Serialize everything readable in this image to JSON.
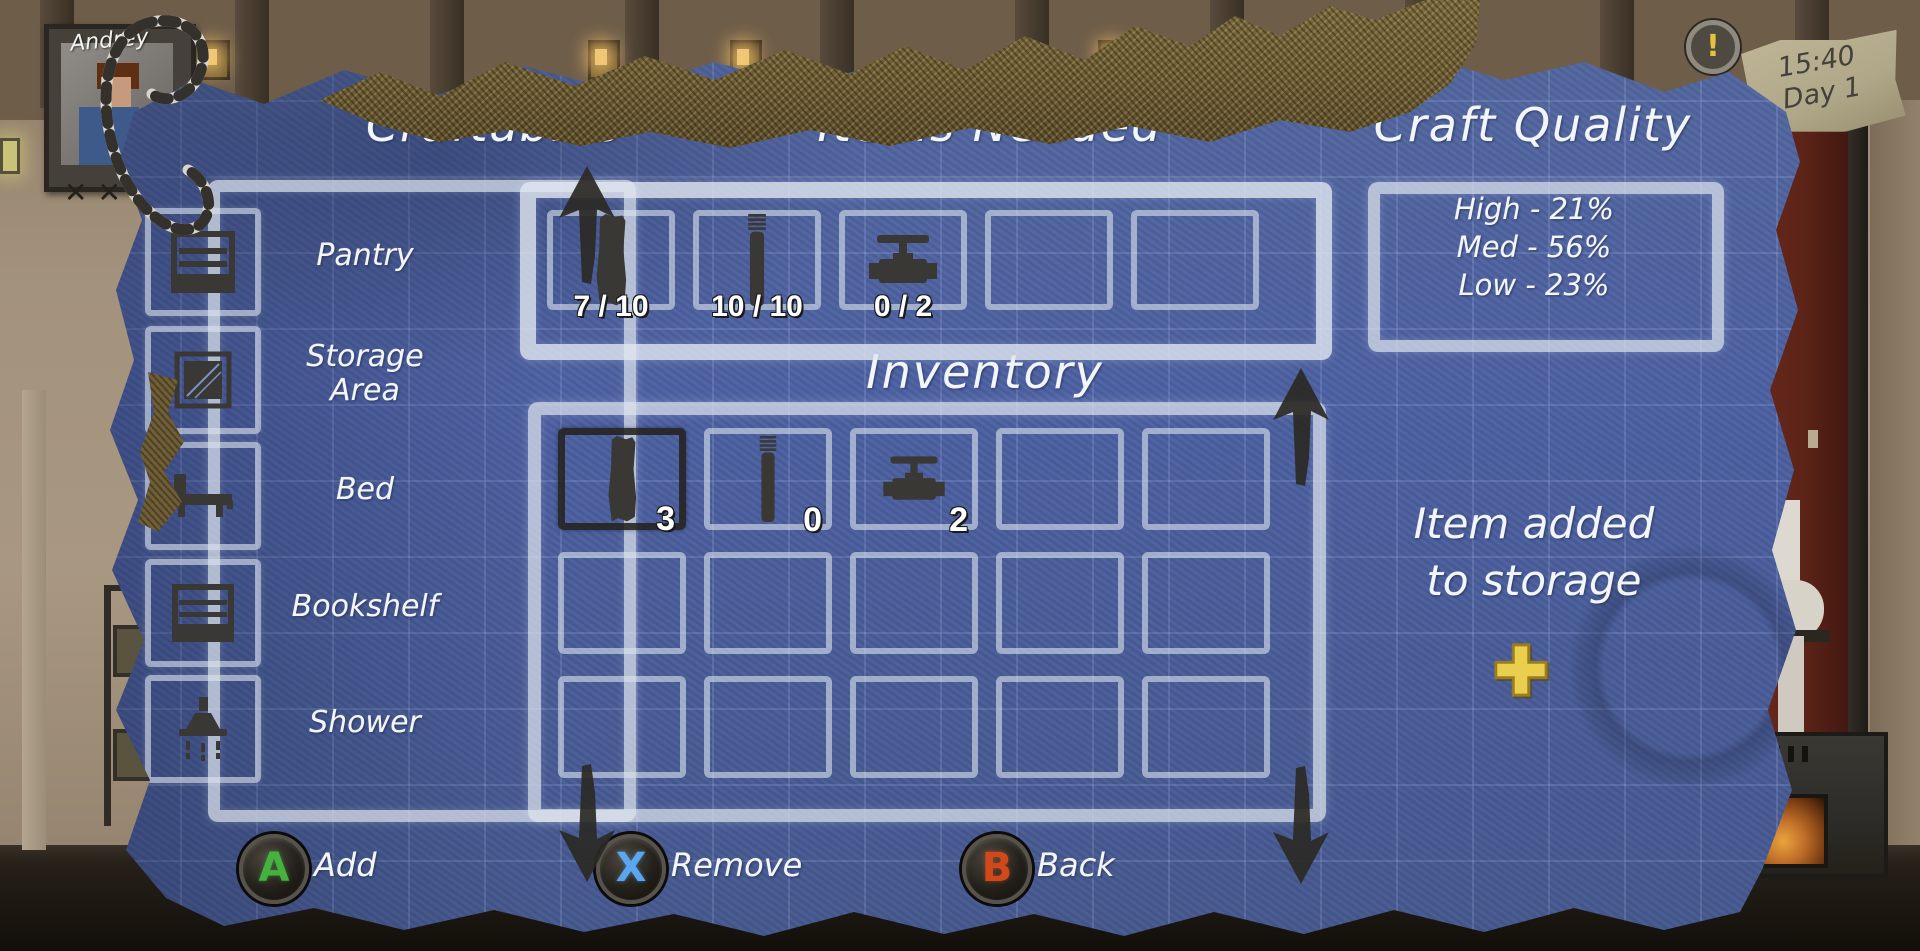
{
  "hud": {
    "character_name": "Andrey",
    "portrait_marks": "✕✕",
    "alert": "!",
    "clock": {
      "time": "15:40",
      "day": "Day 1"
    }
  },
  "panels": {
    "craftables": {
      "title": "Craftables",
      "items": [
        {
          "label": "Pantry",
          "icon": "pantry-icon"
        },
        {
          "label": "Storage Area",
          "icon": "storage-crate-icon"
        },
        {
          "label": "Bed",
          "icon": "bed-icon"
        },
        {
          "label": "Bookshelf",
          "icon": "bookshelf-icon"
        },
        {
          "label": "Shower",
          "icon": "shower-icon"
        }
      ]
    },
    "items_needed": {
      "title": "Items Needed",
      "slots": [
        {
          "icon": "plank-icon",
          "count": "7 / 10"
        },
        {
          "icon": "pipe-icon",
          "count": "10 / 10"
        },
        {
          "icon": "valve-icon",
          "count": "0 / 2"
        },
        {
          "icon": "",
          "count": ""
        },
        {
          "icon": "",
          "count": ""
        }
      ]
    },
    "craft_quality": {
      "title": "Craft Quality",
      "rows": [
        "High - 21%",
        "Med - 56%",
        "Low - 23%"
      ]
    },
    "inventory": {
      "title": "Inventory",
      "slots": [
        {
          "icon": "plank-icon",
          "count": "3",
          "selected": true
        },
        {
          "icon": "pipe-icon",
          "count": "0",
          "selected": false
        },
        {
          "icon": "valve-icon",
          "count": "2",
          "selected": false
        }
      ],
      "empty_slot_count": 12
    },
    "status": {
      "line1": "Item added",
      "line2": "to storage",
      "icon": "plus-icon",
      "plus_color": "#e9cf4d"
    }
  },
  "controls": [
    {
      "button": "A",
      "label": "Add",
      "color": "#45b13f"
    },
    {
      "button": "X",
      "label": "Remove",
      "color": "#5aa7ef"
    },
    {
      "button": "B",
      "label": "Back",
      "color": "#d1491b"
    }
  ],
  "colors": {
    "blueprint": "#4d61a3",
    "chalk": "#e8eef4",
    "burlap": "#6f5e36",
    "icon_dark": "#3a3835"
  }
}
